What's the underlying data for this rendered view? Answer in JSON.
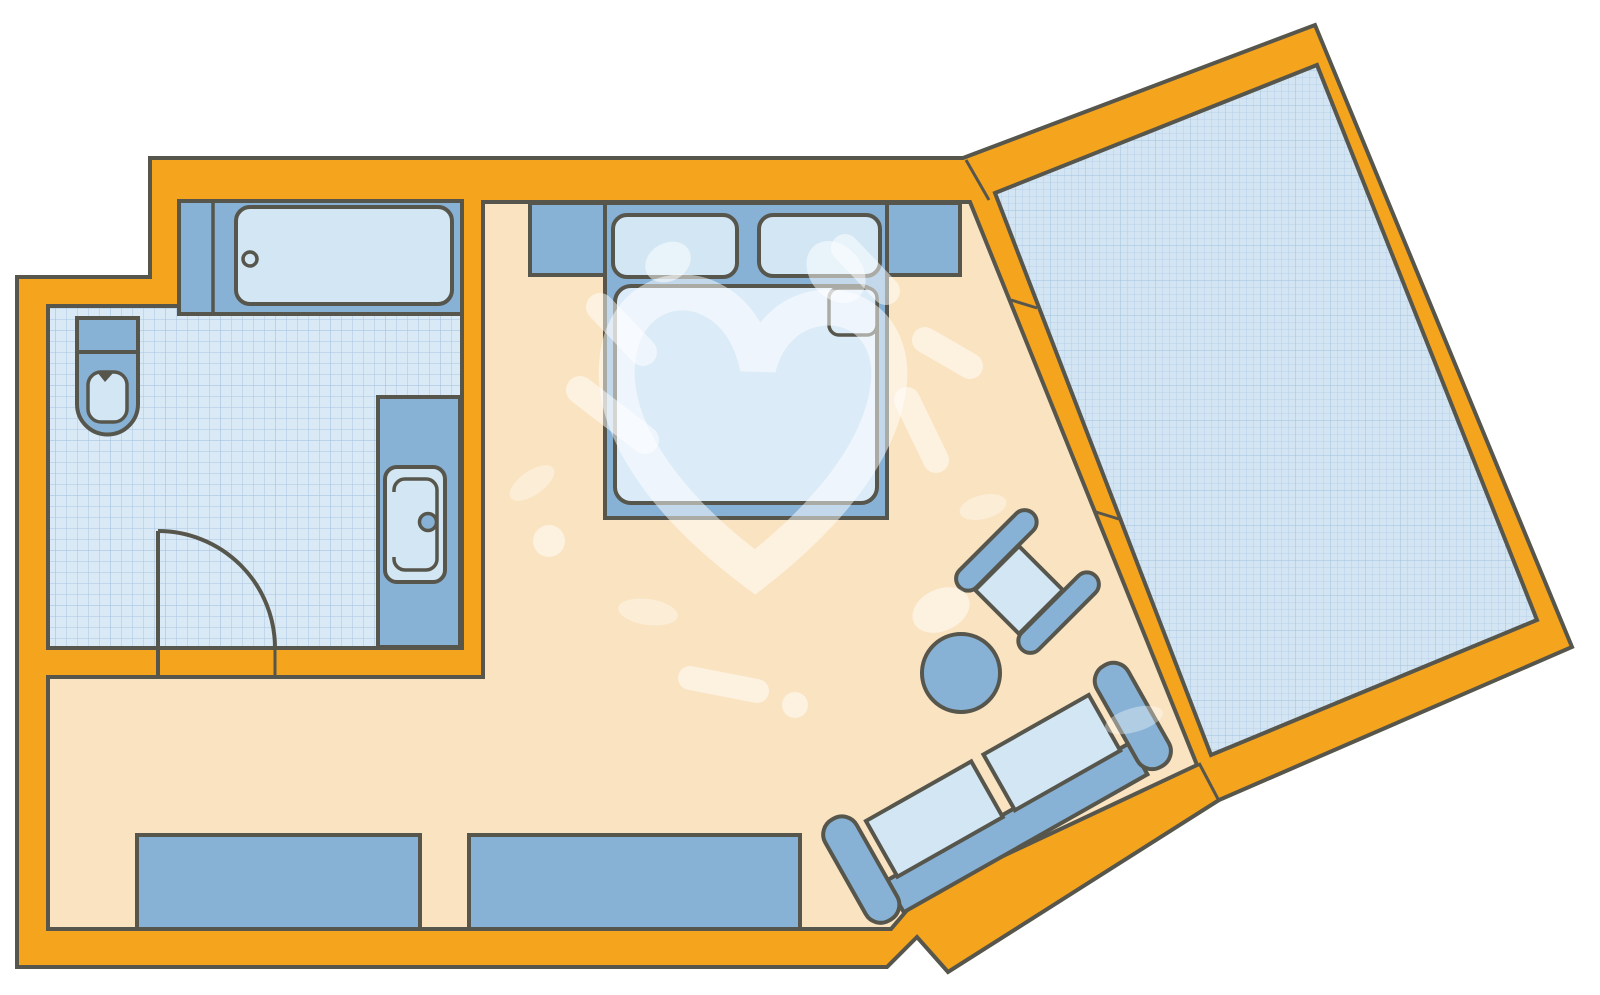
{
  "plan": {
    "kind": "floor-plan-sketch",
    "rooms": [
      {
        "name": "bathroom",
        "floor": "tiled"
      },
      {
        "name": "main-room",
        "floor": "plain"
      },
      {
        "name": "balcony",
        "floor": "tiled",
        "rotated": true
      }
    ],
    "furniture": [
      "bathtub",
      "toilet",
      "washbasin-vanity",
      "bathroom-door-swing",
      "headboard-wall",
      "double-bed",
      "pillow-left",
      "pillow-right",
      "mattress",
      "sideboard-left",
      "sideboard-right",
      "armchair",
      "round-table",
      "sofa"
    ],
    "annotations": [
      "heart-doodle-watermark"
    ]
  },
  "colors": {
    "wall": "#F5A41E",
    "outline": "#57564C",
    "floor": "#FAE3C1",
    "bathroom_floor": "#D9E9F6",
    "balcony_floor": "#D3E5F3",
    "tile_line": "#A9C7E1",
    "furniture": "#87B2D6",
    "furniture_light": "#D3E6F4",
    "mattress_light": "#DCEBF8",
    "watermark": "rgba(255,255,255,0.5)",
    "watermark_soft": "rgba(255,255,255,0.35)"
  }
}
